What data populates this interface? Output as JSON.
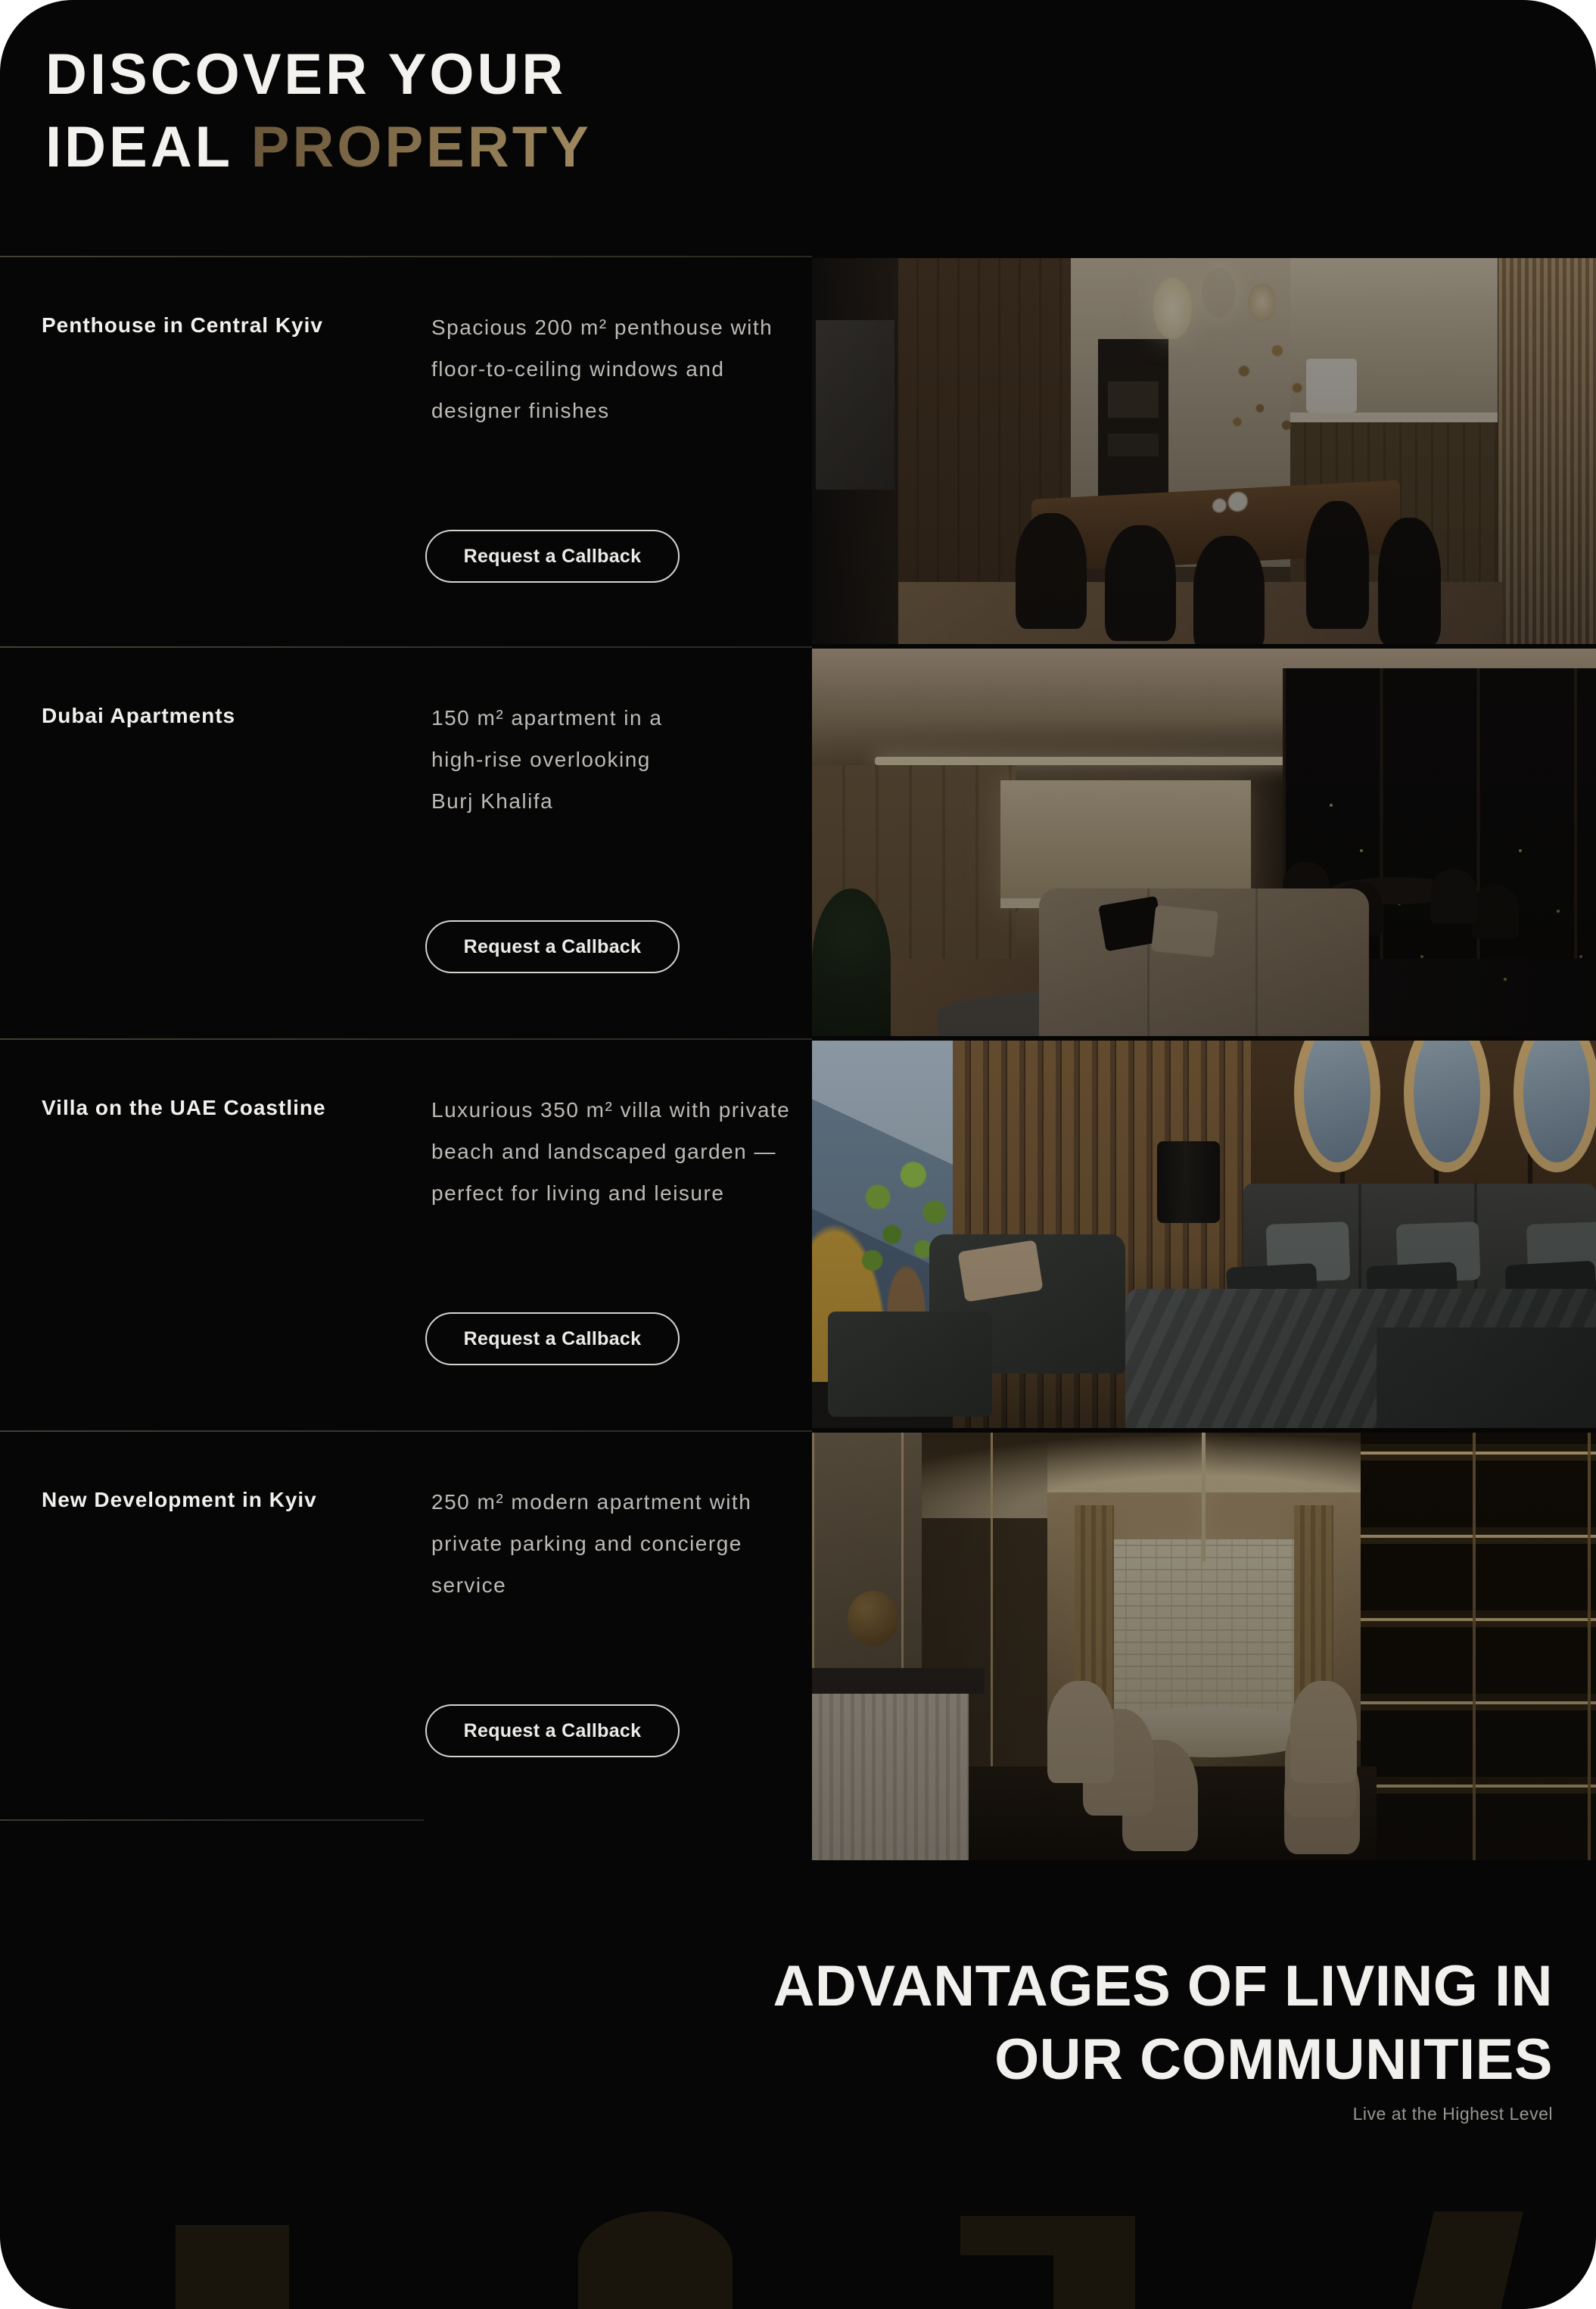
{
  "header": {
    "line1": "DISCOVER YOUR",
    "line2_white": "IDEAL",
    "line2_accent": "PROPERTY"
  },
  "properties": [
    {
      "title": "Penthouse in Central Kyiv",
      "description": "Spacious 200 m² penthouse with\nfloor-to-ceiling windows and\ndesigner finishes",
      "button_label": "Request a Callback"
    },
    {
      "title": "Dubai Apartments",
      "description": "150 m² apartment in a\nhigh-rise overlooking\nBurj Khalifa",
      "button_label": "Request a Callback"
    },
    {
      "title": "Villa on the UAE Coastline",
      "description": "Luxurious 350 m² villa with private\nbeach and landscaped garden —\nperfect for living and leisure",
      "button_label": "Request a Callback"
    },
    {
      "title": "New Development in Kyiv",
      "description": "250 m² modern apartment with\nprivate parking and concierge\nservice",
      "button_label": "Request a Callback"
    }
  ],
  "advantages": {
    "line1": "ADVANTAGES OF LIVING IN",
    "line2": "OUR COMMUNITIES",
    "tagline": "Live at the Highest Level"
  },
  "colors": {
    "page_bg": "#060606",
    "accent_gold": "#8a744e",
    "accent_gold_light": "#a18a60",
    "accent_gold_dark": "#6a563a",
    "title": "#f2f0ec",
    "description": "#bdbab5",
    "divider": "#3a362e",
    "button_border": "#d6d3cd",
    "button_text": "#edebe7",
    "tagline": "#99968f",
    "watermark": "#1a150c"
  }
}
